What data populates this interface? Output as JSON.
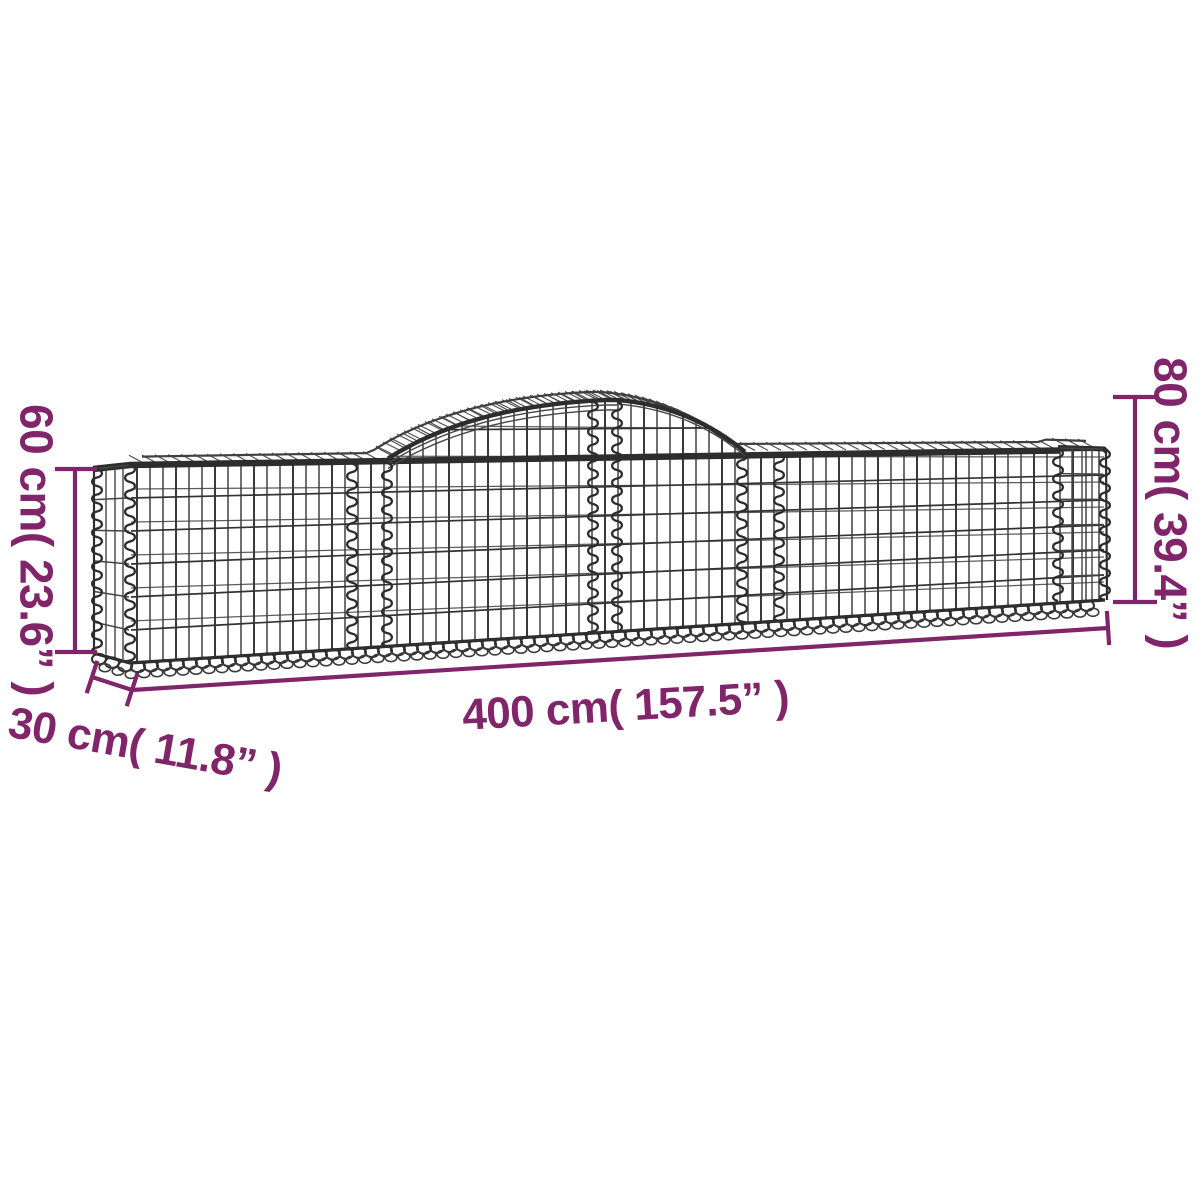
{
  "diagram": {
    "type": "product-dimension-diagram",
    "subject": "arched gabion wire-mesh basket",
    "labels": {
      "height_left": "60 cm( 23.6” )",
      "height_right": "80 cm( 39.4” )",
      "depth": "30 cm( 11.8” )",
      "length": "400 cm( 157.5” )"
    },
    "measurements": {
      "height_left_cm": 60,
      "height_left_in": 23.6,
      "height_right_cm": 80,
      "height_right_in": 39.4,
      "depth_cm": 30,
      "depth_in": 11.8,
      "length_cm": 400,
      "length_in": 157.5
    },
    "colors": {
      "dimension_accent": "#81256A",
      "mesh_dark": "#2D2D2D",
      "background": "#FFFFFF"
    }
  }
}
